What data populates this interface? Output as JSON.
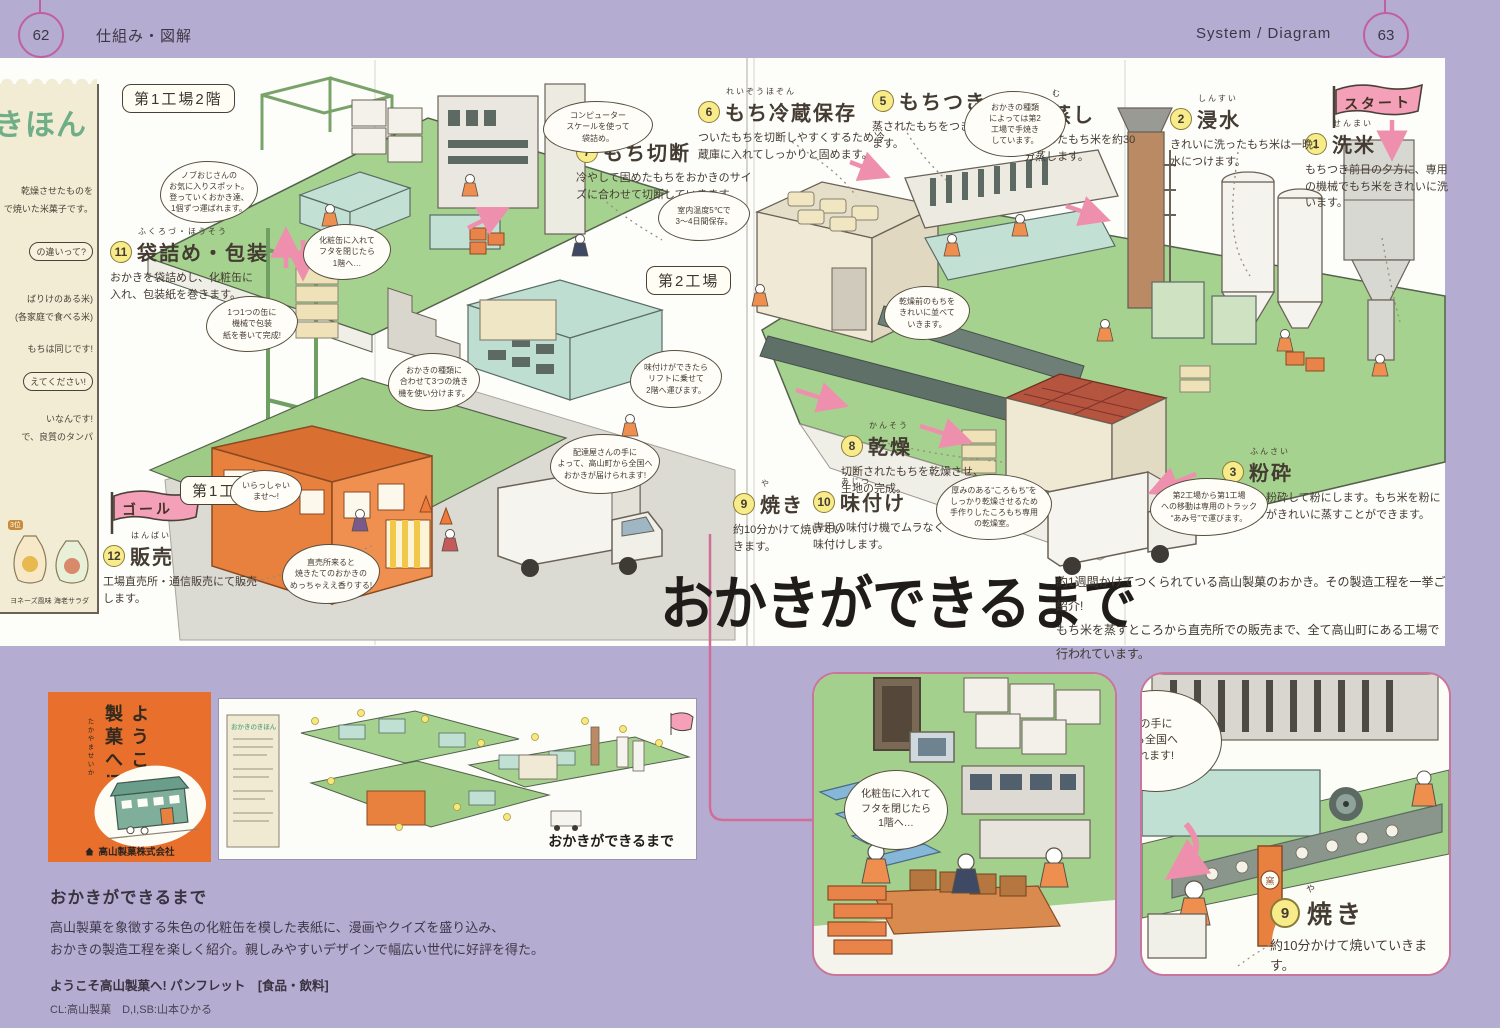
{
  "page": {
    "left_number": "62",
    "left_tab": "仕組み・図解",
    "right_tab": "System / Diagram",
    "right_number": "63"
  },
  "diagram": {
    "title": "おかきができるまで",
    "intro_line1": "約1週間かけてつくられている高山製菓のおかき。その製造工程を一挙ご紹介!",
    "intro_line2": "もち米を蒸すところから直売所での販売まで、全て高山町にある工場で行われています。",
    "start_flag": "スタート",
    "goal_flag": "ゴール",
    "area_labels": [
      "第1工場2階",
      "第2工場",
      "第1工場1階"
    ],
    "steps": [
      {
        "num": "1",
        "furigana": "せんまい",
        "title": "洗米",
        "desc": "もちつき前日の夕方に、専用の機械でもち米をきれいに洗います。"
      },
      {
        "num": "2",
        "furigana": "しんすい",
        "title": "浸水",
        "desc": "きれいに洗ったもち米は一晩、水につけます。"
      },
      {
        "num": "3",
        "furigana": "ふんさい",
        "title": "粉砕",
        "desc": "もち米を粉砕して粉にします。もち米を粉にしたほうがきれいに蒸すことができます。"
      },
      {
        "num": "4",
        "furigana": "む",
        "title": "蒸し",
        "desc": "粉砕したもち米を約30分蒸します。"
      },
      {
        "num": "5",
        "furigana": "",
        "title": "もちつき",
        "desc": "蒸されたもちをつきます。"
      },
      {
        "num": "6",
        "furigana": "れいぞうほぞん",
        "title": "もち冷蔵保存",
        "desc": "ついたもちを切断しやすくするため冷蔵庫に入れてしっかりと固めます。"
      },
      {
        "num": "7",
        "furigana": "せつだん",
        "title": "もち切断",
        "desc": "冷やして固めたもちをおかきのサイズに合わせて切断していきます。"
      },
      {
        "num": "8",
        "furigana": "かんそう",
        "title": "乾燥",
        "desc": "切断されたもちを乾燥させ、生地の完成。"
      },
      {
        "num": "9",
        "furigana": "や",
        "title": "焼き",
        "desc": "約10分かけて焼いていきます。"
      },
      {
        "num": "10",
        "furigana": "あじつ",
        "title": "味付け",
        "desc": "専用の味付け機でムラなく味付けします。"
      },
      {
        "num": "11",
        "furigana": "ふくろづ・ほうそう",
        "title": "袋詰め・包装",
        "desc": "おかきを袋詰めし、化粧缶に入れ、包装紙を巻きます。"
      },
      {
        "num": "12",
        "furigana": "はんばい",
        "title": "販売",
        "desc": "工場直売所・通信販売にて販売します。"
      }
    ],
    "bubbles": [
      "コンピューター\nスケールを使って\n袋詰め。",
      "おかきの種類\nによっては第2\n工場で手焼き\nしています。",
      "室内温度5℃で\n3〜4日間保存。",
      "化粧缶に入れて\nフタを閉じたら\n1階へ…",
      "1つ1つの缶に\n機械で包装\n紙を巻いて完成!",
      "ノブおじさんの\nお気に入りスポット。\n登っていくおかき達、\n1個ずつ運ばれます。",
      "おかきの種類に\n合わせて3つの焼き\n機を使い分けます。",
      "味付けができたら\nリフトに乗せて\n2階へ運びます。",
      "配達屋さんの手に\nよって、高山町から全国へ\nおかきが届けられます!",
      "いらっしゃい\nませ〜!",
      "直売所来ると\n焼きたてのおかきの\nめっちゃええ香りする!",
      "厚みのある“ころもち”を\nしっかり乾燥させるため\n手作りしたころもち専用\nの乾燥室。",
      "第2工場から第1工場\nへの移動は専用のトラック\n“あみ号”で運びます。",
      "乾燥前のもちを\nきれいに並べて\nいきます。"
    ],
    "notes_panel": {
      "title": "きほん",
      "fragments": [
        "乾燥させたものを",
        "で焼いた米菓子です。",
        "の違いって?",
        "ばりけのある米)",
        "(各家庭で食べる米)",
        "もちは同じです!",
        "えてください!",
        "いなんです!",
        "で、良質のタンパ"
      ],
      "products": [
        "ヨネーズ風味",
        "海老サラダ"
      ],
      "rank": "3位"
    }
  },
  "bottom": {
    "cover": {
      "title": "ようこそ高山製菓へ!",
      "furigana": "たかやませいか",
      "company": "高山製菓株式会社"
    },
    "mini": {
      "notes_title": "おかきのきほん",
      "caption": "おかきができるまで"
    },
    "crop1": {
      "bubble": "化粧缶に入れて\nフタを閉じたら\n1階へ…"
    },
    "crop2": {
      "bubble_fragment": "の手に\nら全国へ\nれます!",
      "kiln_mark": "窯",
      "step_num": "9",
      "step_furi": "や",
      "step_title": "焼き",
      "step_desc": "約10分かけて焼いていきます。"
    },
    "description": {
      "title": "おかきができるまで",
      "body_line1": "高山製菓を象徴する朱色の化粧缶を模した表紙に、漫画やクイズを盛り込み、",
      "body_line2": "おかきの製造工程を楽しく紹介。親しみやすいデザインで幅広い世代に好評を得た。",
      "caption": "ようこそ高山製菓へ! パンフレット　[食品・飲料]",
      "credits": "CL:高山製菓　D,I,SB:山本ひかる"
    }
  },
  "colors": {
    "lavender": "#b5acd2",
    "accent_pink": "#cf6f97",
    "cover_orange": "#e8702c",
    "floor_green": "#a6d28f",
    "step_yellow": "#f8ec8a"
  }
}
